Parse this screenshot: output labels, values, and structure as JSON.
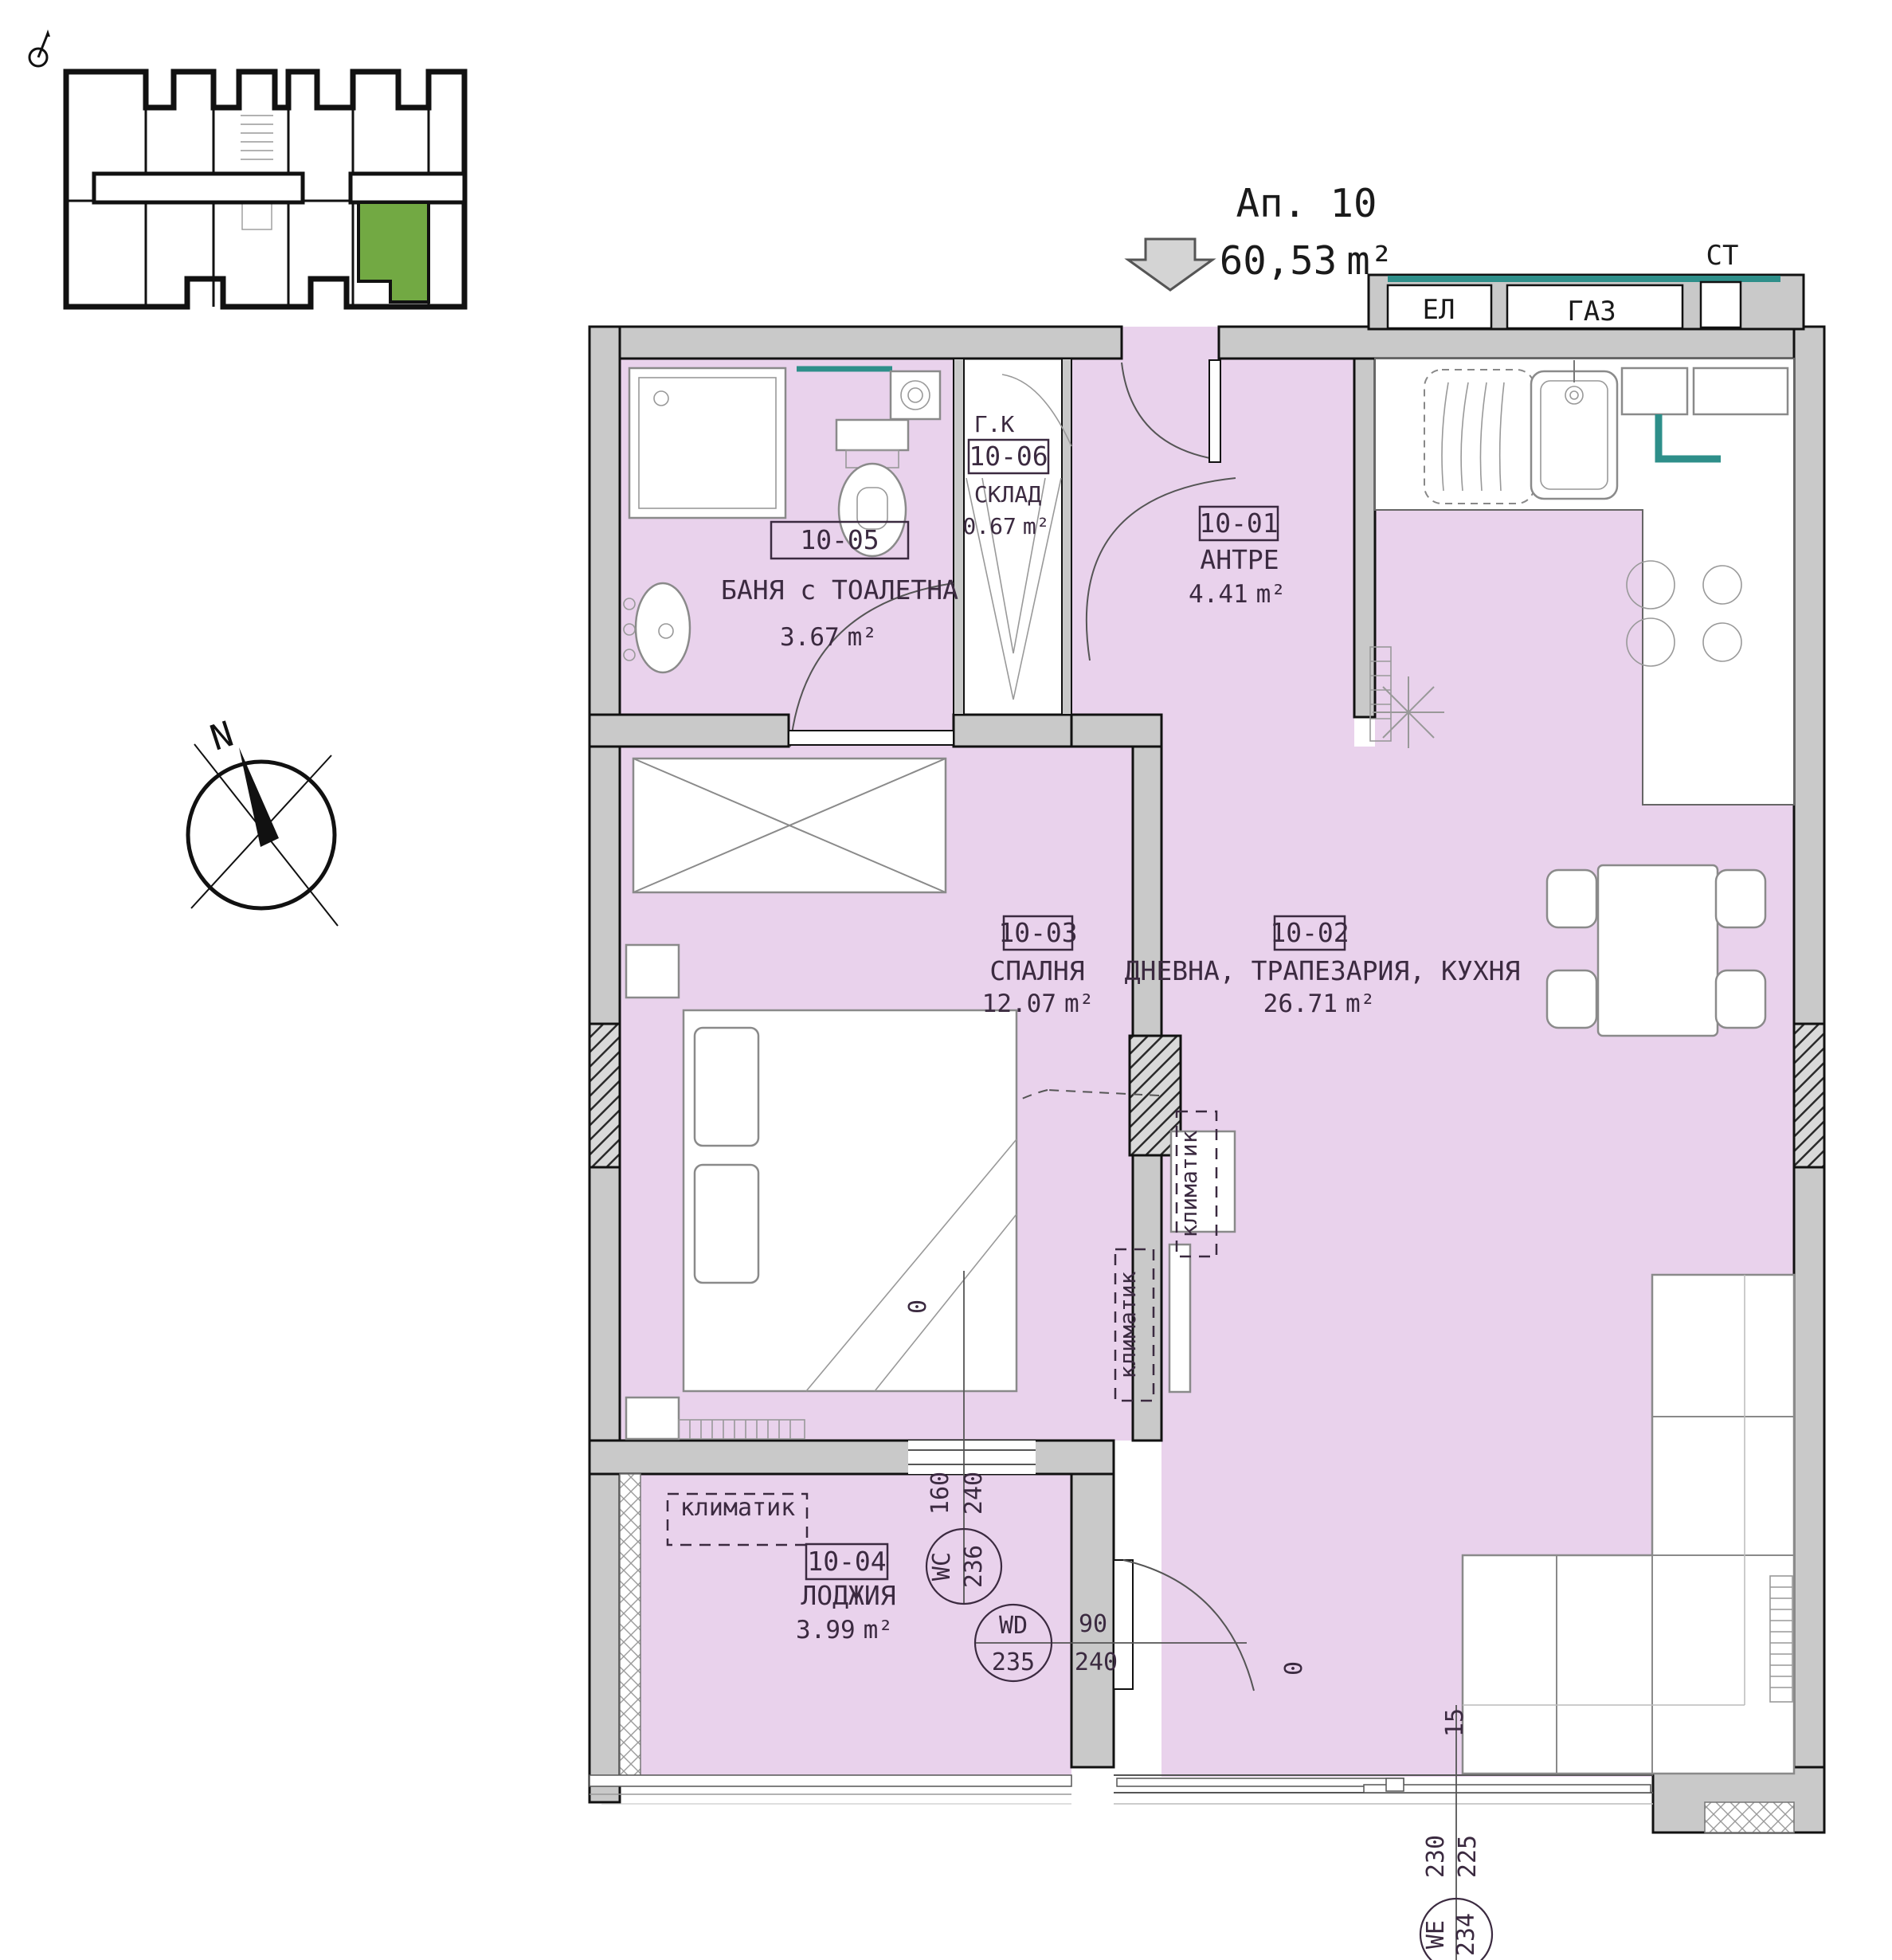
{
  "title": {
    "apartment": "Ап. 10",
    "area": "60,53",
    "unit": "m²"
  },
  "shaft_labels": {
    "el": "ЕЛ",
    "gas": "ГАЗ",
    "st": "СТ"
  },
  "compass": {
    "north": "N"
  },
  "rooms": [
    {
      "id": "10-01",
      "name": "АНТРЕ",
      "area": "4.41",
      "unit": "m²"
    },
    {
      "id": "10-02",
      "name": "ДНЕВНА, ТРАПЕЗАРИЯ, КУХНЯ",
      "area": "26.71",
      "unit": "m²"
    },
    {
      "id": "10-03",
      "name": "СПАЛНЯ",
      "area": "12.07",
      "unit": "m²"
    },
    {
      "id": "10-04",
      "name": "ЛОДЖИЯ",
      "area": "3.99",
      "unit": "m²"
    },
    {
      "id": "10-05",
      "name": "БАНЯ с ТОАЛЕТНА",
      "area": "3.67",
      "unit": "m²"
    },
    {
      "id": "10-06",
      "name": "СКЛАД",
      "area": "0.67",
      "unit": "m²"
    }
  ],
  "annotations": {
    "boiler": "Г.К",
    "ac": "климатик",
    "zero_a": "0",
    "zero_b": "0",
    "sill": "15"
  },
  "openings": [
    {
      "code": "WC",
      "num": "236",
      "w": "160",
      "h": "240"
    },
    {
      "code": "WD",
      "num": "235",
      "w": "90",
      "h": "240"
    },
    {
      "code": "WE",
      "num": "234",
      "w": "230",
      "h": "225"
    }
  ],
  "colors": {
    "room_fill": "#e9d2ec",
    "wall_fill": "#c9c9c9",
    "highlight_green": "#72a943",
    "accent_teal": "#2e8f8a"
  }
}
